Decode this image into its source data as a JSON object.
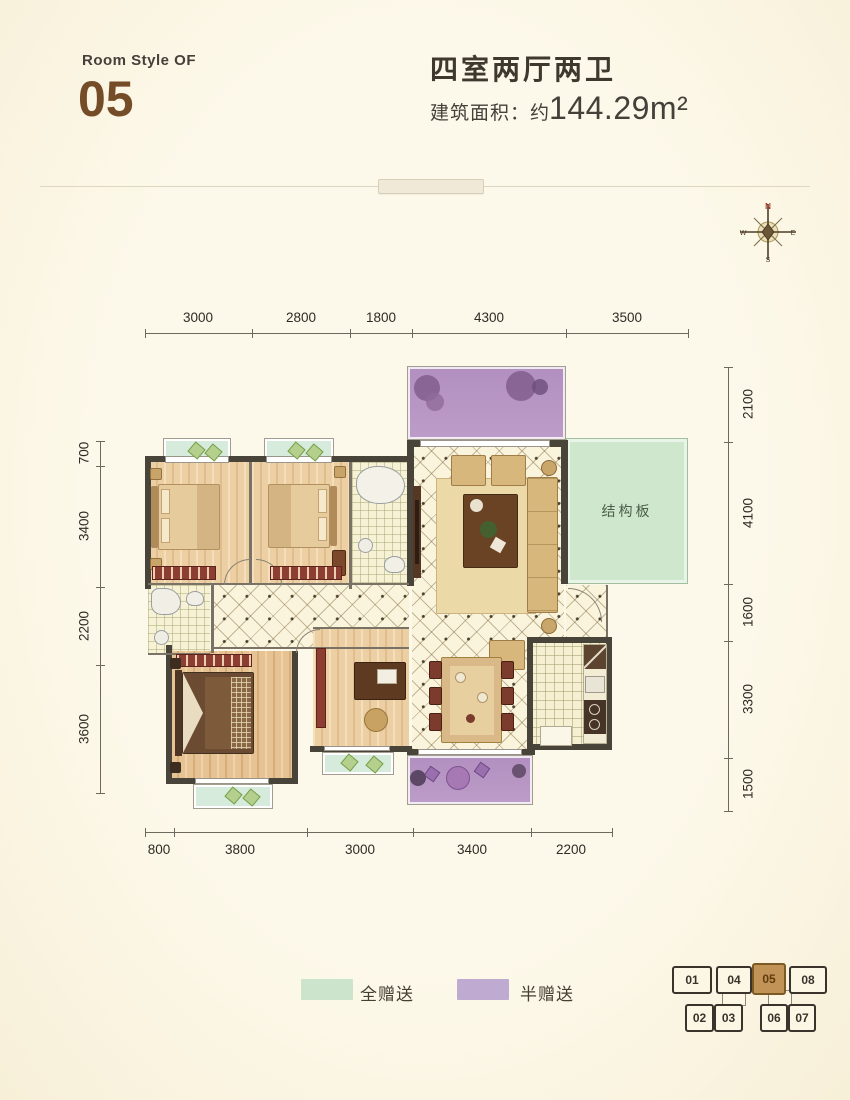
{
  "header": {
    "room_style_label": "Room Style OF",
    "room_number": "05",
    "layout_title": "四室两厅两卫",
    "area_label": "建筑面积：",
    "area_approx": "约",
    "area_value": "144.29m²"
  },
  "compass": {
    "north": "N",
    "east": "E",
    "south": "S",
    "west": "W"
  },
  "dimensions": {
    "top": [
      "3000",
      "2800",
      "1800",
      "4300",
      "3500"
    ],
    "bottom": [
      "800",
      "3800",
      "3000",
      "3400",
      "2200"
    ],
    "left": [
      "700",
      "3400",
      "2200",
      "3600"
    ],
    "right": [
      "2100",
      "4100",
      "1600",
      "3300",
      "1500"
    ]
  },
  "plan": {
    "structural_slab_label": "结构板"
  },
  "legend": {
    "full_gift": {
      "label": "全赠送",
      "color": "#cde4cc"
    },
    "half_gift": {
      "label": "半赠送",
      "color": "#bfaad2"
    }
  },
  "key_plan": {
    "highlighted_unit": "05",
    "top_row": [
      "01",
      "04",
      "05",
      "08"
    ],
    "bottom_row": [
      "02",
      "03",
      "06",
      "07"
    ]
  },
  "colors": {
    "accent_brown": "#744c28",
    "gift_green": "#cde4cc",
    "gift_purple": "#bfaad2",
    "wall": "#49443a",
    "highlight_unit_fill": "#c29356"
  }
}
